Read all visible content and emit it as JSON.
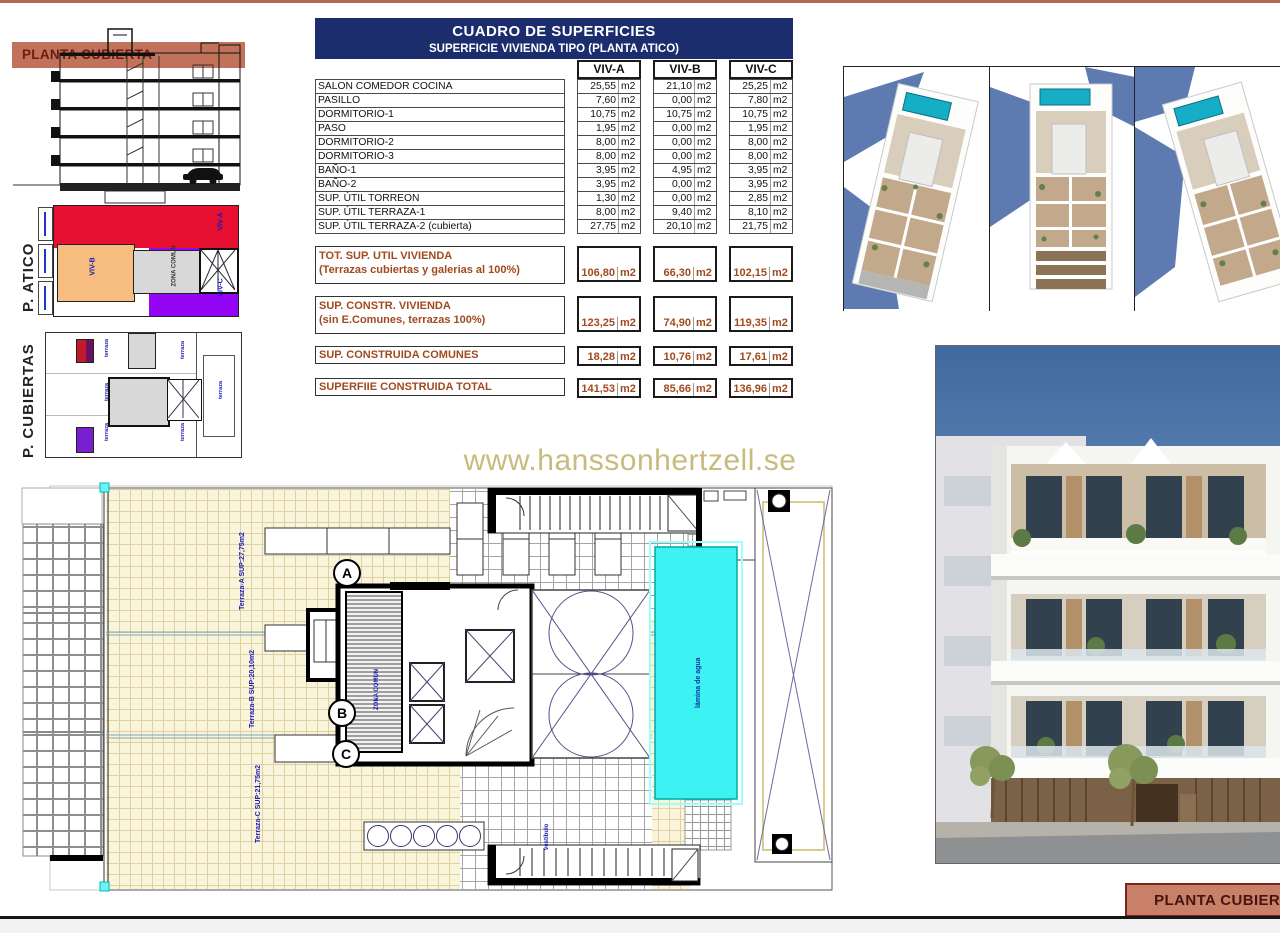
{
  "page": {
    "watermark": "www.hanssonhertzell.se",
    "bottom_label": "PLANTA CUBIERTA"
  },
  "colors": {
    "header_navy": "#1c2d6e",
    "summary_brown": "#a04a1e",
    "band_salmon": "#c1725a",
    "unit_a_red": "#e81030",
    "unit_b_orange": "#f7bd7f",
    "unit_c_purple": "#9405f5",
    "pool_cyan": "#3cf2f2",
    "watermark_gold": "#c9ba7d",
    "plan_label_blue": "#1818b8"
  },
  "section_drawing": {
    "band_label": "PLANTA CUBIERTA"
  },
  "atico_plan": {
    "side_label": "P. ATICO",
    "unit_a": "VIV-A",
    "unit_b": "VIV-B",
    "unit_c": "VIV-C",
    "core_label": "ZONA COMUN"
  },
  "cubiertas_plan": {
    "side_label": "P. CUBIERTAS",
    "terraza_label": "terraza"
  },
  "table": {
    "title": "CUADRO DE SUPERFICIES",
    "subtitle": "SUPERFICIE VIVIENDA TIPO  (PLANTA ATICO)",
    "columns": [
      "VIV-A",
      "VIV-B",
      "VIV-C"
    ],
    "unit": "m2",
    "rows": [
      {
        "label": "SALON COMEDOR COCINA",
        "a": "25,55",
        "b": "21,10",
        "c": "25,25"
      },
      {
        "label": "PASILLO",
        "a": "7,60",
        "b": "0,00",
        "c": "7,80"
      },
      {
        "label": "DORMITORIO-1",
        "a": "10,75",
        "b": "10,75",
        "c": "10,75"
      },
      {
        "label": "PASO",
        "a": "1,95",
        "b": "0,00",
        "c": "1,95"
      },
      {
        "label": "DORMITORIO-2",
        "a": "8,00",
        "b": "0,00",
        "c": "8,00"
      },
      {
        "label": "DORMITORIO-3",
        "a": "8,00",
        "b": "0,00",
        "c": "8,00"
      },
      {
        "label": "BAÑO-1",
        "a": "3,95",
        "b": "4,95",
        "c": "3,95"
      },
      {
        "label": "BAÑO-2",
        "a": "3,95",
        "b": "0,00",
        "c": "3,95"
      },
      {
        "label": "SUP. ÚTIL TORREON",
        "a": "1,30",
        "b": "0,00",
        "c": "2,85"
      },
      {
        "label": "SUP. ÚTIL TERRAZA-1",
        "a": "8,00",
        "b": "9,40",
        "c": "8,10"
      },
      {
        "label": "SUP. ÚTIL TERRAZA-2 (cubierta)",
        "a": "27,75",
        "b": "20,10",
        "c": "21,75"
      }
    ],
    "summary_rows": [
      {
        "label": "TOT. SUP. UTIL VIVIENDA",
        "sublabel": "(Terrazas cubiertas y galerias al 100%)",
        "a": "106,80",
        "b": "66,30",
        "c": "102,15"
      },
      {
        "label": "SUP. CONSTR. VIVIENDA",
        "sublabel": "(sin E.Comunes, terrazas 100%)",
        "a": "123,25",
        "b": "74,90",
        "c": "119,35"
      },
      {
        "label": "SUP. CONSTRUIDA COMUNES",
        "sublabel": "",
        "a": "18,28",
        "b": "10,76",
        "c": "17,61"
      },
      {
        "label": "SUPERFIIE CONSTRUIDA TOTAL",
        "sublabel": "",
        "a": "141,53",
        "b": "85,66",
        "c": "136,96"
      }
    ]
  },
  "floor_plan": {
    "stairs": [
      "A",
      "B",
      "C"
    ],
    "labels": {
      "terrace_a": "Terraza-A SUP:27,75m2",
      "terrace_b": "Terraza-B SUP:20,10m2",
      "terrace_c": "Terraza-C SUP:21,75m2",
      "pool": "lámina de agua",
      "core": "ZONA COMUN",
      "lobby": "vestíbulo"
    }
  }
}
